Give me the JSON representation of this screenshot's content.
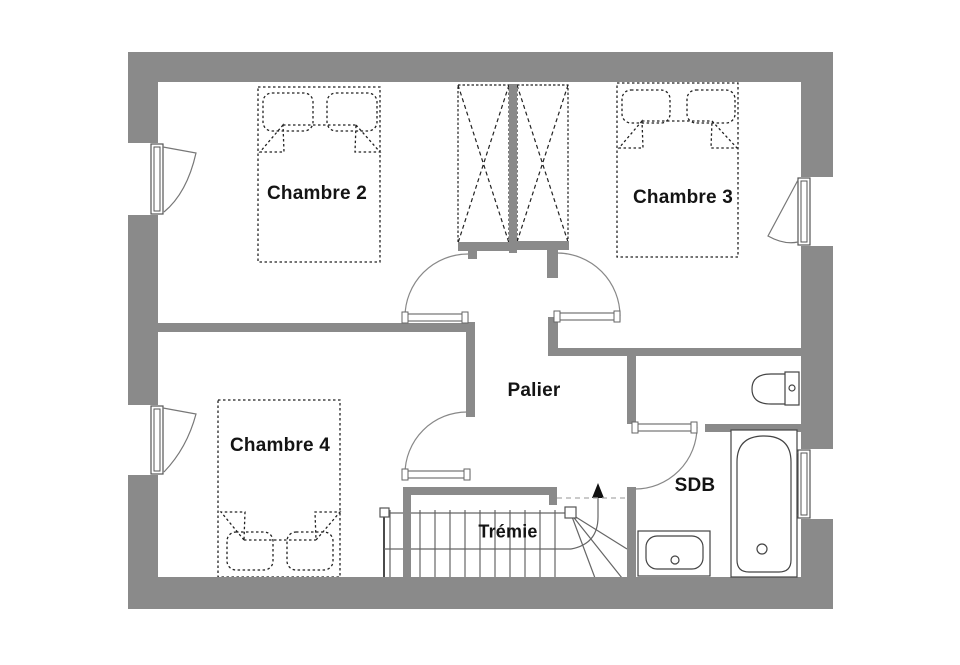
{
  "rooms": {
    "chambre2": "Chambre 2",
    "chambre3": "Chambre 3",
    "chambre4": "Chambre 4",
    "palier": "Palier",
    "tremie": "Trémie",
    "sdb": "SDB"
  },
  "colors": {
    "wall": "#8a8a8a",
    "line": "#555555",
    "furniture": "#222222",
    "background": "#ffffff"
  }
}
